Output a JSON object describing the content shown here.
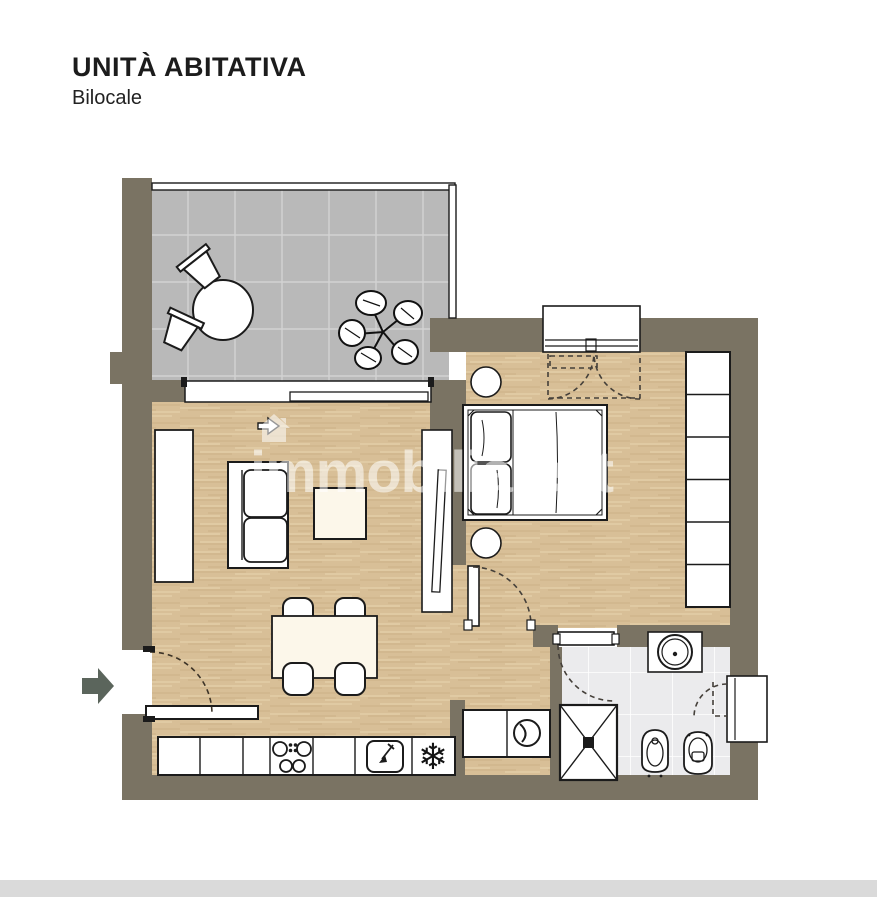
{
  "header": {
    "title": "UNITÀ ABITATIVA",
    "subtitle": "Bilocale"
  },
  "watermark": {
    "text": "immobiliare.it",
    "logo": "house-icon"
  },
  "colors": {
    "background": "#ffffff",
    "wall": "#7a7363",
    "wood_floor": "#d8bf97",
    "balcony_tile": "#b9b9b9",
    "bath_tile": "#ebebed",
    "outline": "#1b1b1b",
    "furniture_white": "#ffffff",
    "entry_arrow": "#5b655c",
    "bottom_strip": "#dadada"
  },
  "plan": {
    "rooms": [
      "balcony-terrace",
      "living-room-with-kitchen",
      "bedroom",
      "bathroom",
      "laundry-niche"
    ],
    "furniture_icons": [
      "round-table-icon",
      "outdoor-chair-icon",
      "plant-icon",
      "sofa-icon",
      "coffee-table-icon",
      "tv-cabinet-icon",
      "tall-cabinet-icon",
      "dining-table-icon",
      "dining-chair-icon",
      "kitchen-counter-icon",
      "cooktop-icon",
      "sink-icon",
      "fridge-snowflake-icon",
      "double-bed-icon",
      "nightstand-icon",
      "wardrobe-icon",
      "washing-machine-icon",
      "shower-icon",
      "washbasin-icon",
      "bidet-icon",
      "toilet-icon",
      "entry-arrow-icon",
      "door-swing-arc",
      "window-icon",
      "sliding-door-icon"
    ]
  }
}
